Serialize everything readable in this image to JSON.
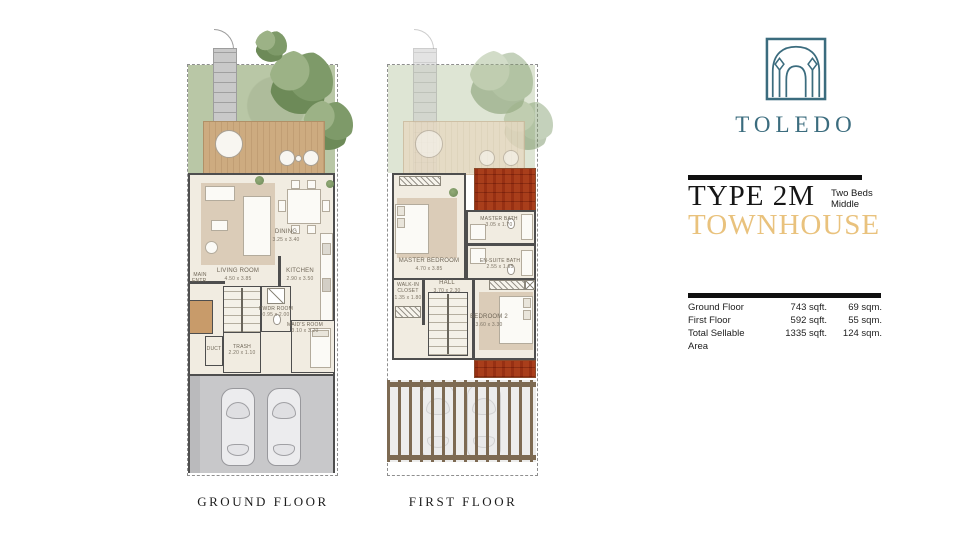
{
  "brand": {
    "name": "TOLEDO",
    "logo_icon": "moorish-arches-icon",
    "brand_color": "#3B6C7E"
  },
  "title_block": {
    "type_label": "TYPE 2M",
    "beds_line1": "Two Beds",
    "beds_line2": "Middle",
    "category": "TOWNHOUSE",
    "category_color": "#E9C27D"
  },
  "area_table": {
    "rows": [
      {
        "label": "Ground Floor",
        "sqft": "743 sqft.",
        "sqm": "69 sqm."
      },
      {
        "label": "First Floor",
        "sqft": "592 sqft.",
        "sqm": "55 sqm."
      },
      {
        "label": "Total Sellable Area",
        "sqft": "1335 sqft.",
        "sqm": "124 sqm."
      }
    ]
  },
  "plans": {
    "ground": {
      "caption": "GROUND FLOOR",
      "rooms": {
        "living": {
          "name": "LIVING ROOM",
          "dims": "4.50 x 3.85"
        },
        "dining": {
          "name": "DINING",
          "dims": "3.25 x 3.40"
        },
        "kitchen": {
          "name": "KITCHEN",
          "dims": "2.90 x 3.50"
        },
        "pwdr": {
          "name": "PWDR ROOM",
          "dims": "0.95 x 2.00"
        },
        "maids": {
          "name": "MAID'S ROOM",
          "dims": "3.10 x 3.20"
        },
        "trash": {
          "name": "TRASH",
          "dims": "2.20 x 1.10"
        },
        "duct": {
          "name": "DUCT",
          "dims": ""
        },
        "entry": {
          "name": "MAIN ENTR.",
          "dims": ""
        }
      }
    },
    "first": {
      "caption": "FIRST FLOOR",
      "rooms": {
        "master": {
          "name": "MASTER BEDROOM",
          "dims": "4.70 x 3.85"
        },
        "mbath": {
          "name": "MASTER BATH",
          "dims": "3.05 x 1.70"
        },
        "ensuite": {
          "name": "EN-SUITE BATH",
          "dims": "2.55 x 1.65"
        },
        "walkin": {
          "name": "WALK-IN CLOSET",
          "dims": "1.35 x 1.80"
        },
        "hall": {
          "name": "HALL",
          "dims": "3.70 x 2.30"
        },
        "bedroom2": {
          "name": "BEDROOM 2",
          "dims": "3.60 x 3.30"
        }
      }
    }
  },
  "plan_colors": {
    "garden": "#B9C7A6",
    "deck_wood": "#CDAB80",
    "walls": "#4E4E4E",
    "interior_floor": "#F1ECE1",
    "roof_terracotta": "#C06A40",
    "driveway": "#C8C8CA",
    "pergola_wood": "#7D6A52"
  }
}
